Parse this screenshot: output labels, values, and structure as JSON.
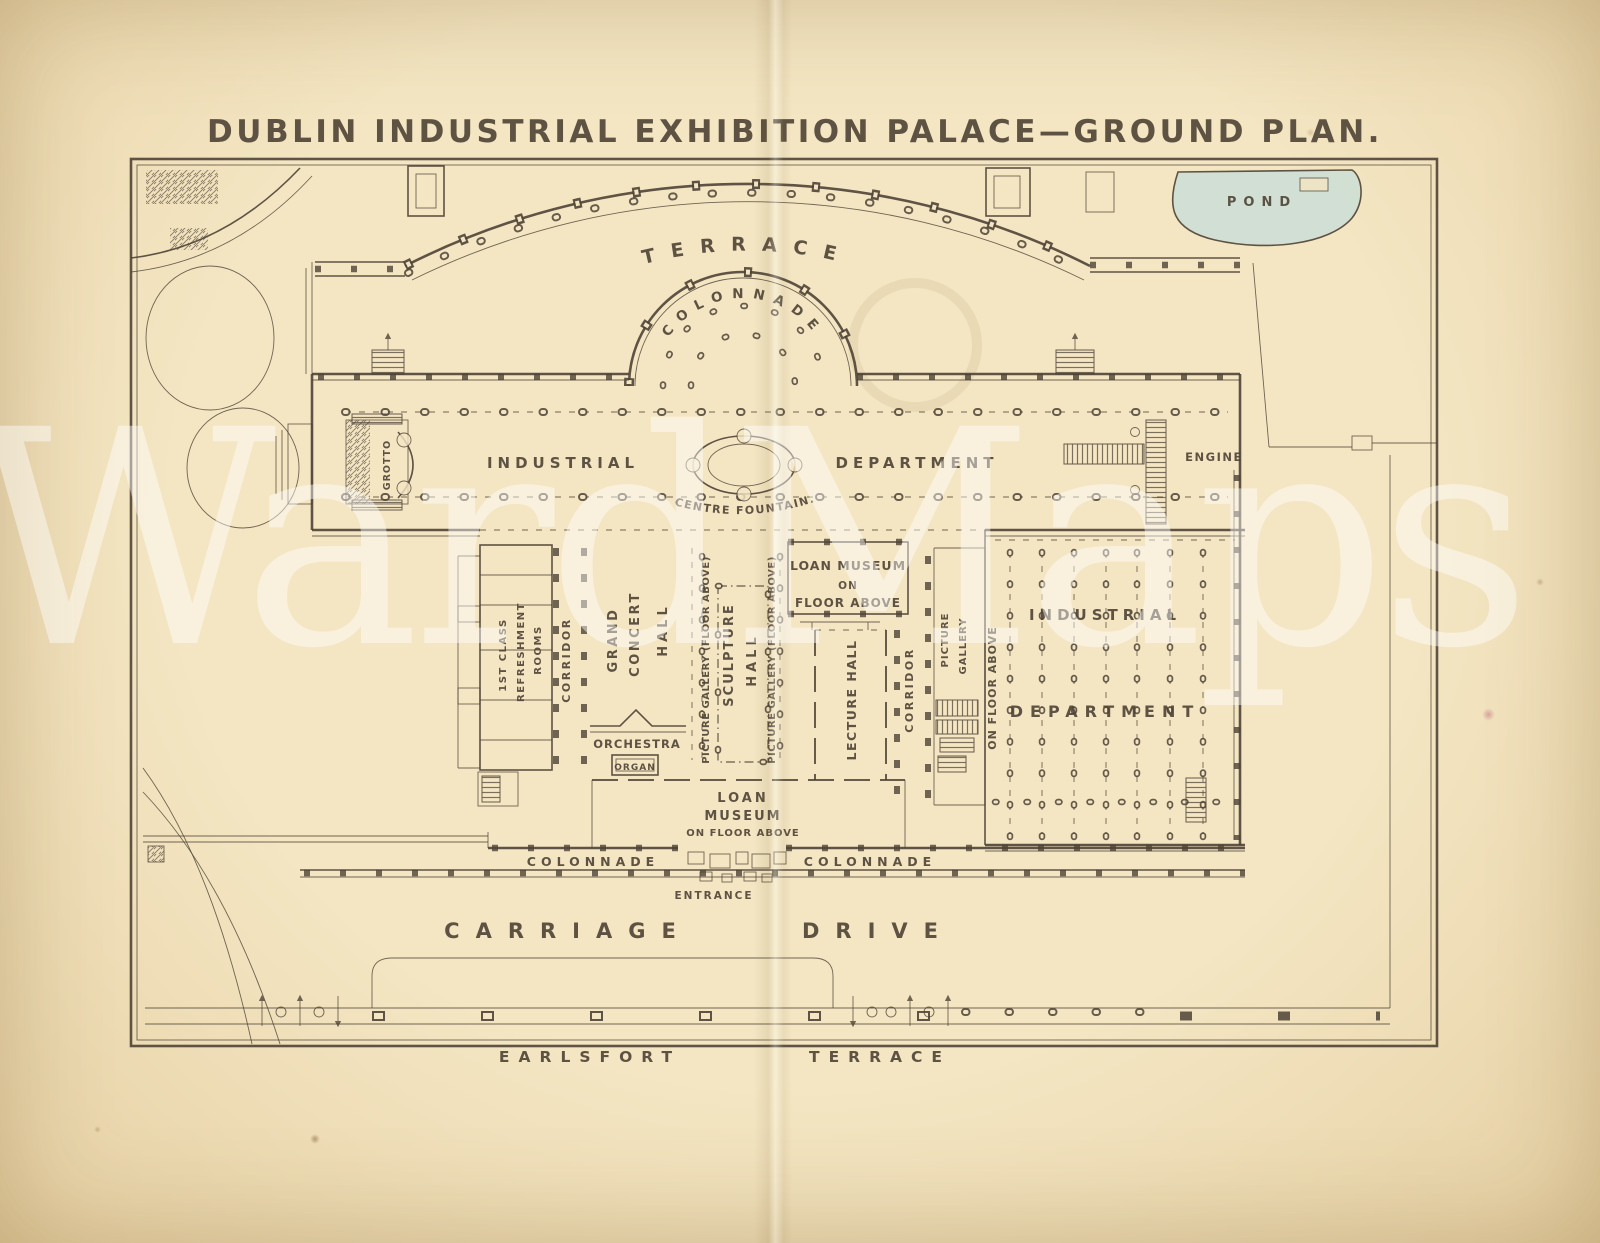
{
  "palette": {
    "paper": "#f4e6c3",
    "paper_edge": "#e6d0a4",
    "ink": "#4e4336",
    "pond": "#cfdfd6",
    "watermark": "rgba(255,255,255,0.45)"
  },
  "title": "DUBLIN INDUSTRIAL EXHIBITION PALACE—GROUND PLAN.",
  "watermark_text": "WardMaps",
  "plan": {
    "terrace": "TERRACE",
    "colonnade_arc": "COLONNADE",
    "pond": "POND",
    "industrial_hall_west": "INDUSTRIAL",
    "industrial_hall_east": "DEPARTMENT",
    "centre_fountain": "CENTRE FOUNTAIN.",
    "engine": "ENGINE",
    "grotto": "GROTTO",
    "first_class": "1ST CLASS",
    "refreshment": "REFRESHMENT",
    "rooms": "ROOMS",
    "corridor_west": "CORRIDOR",
    "grand": "GRAND",
    "concert": "CONCERT",
    "concert_hall": "HALL",
    "orchestra": "ORCHESTRA",
    "organ": "ORGAN",
    "picture_gallery_west": "PICTURE GALLERY (FLOOR ABOVE)",
    "sculpture": "SCULPTURE",
    "sculpture_hall": "HALL",
    "picture_gallery_east": "PICTURE GALLERY (FLOOR ABOVE)",
    "loan_museum_north_1": "LOAN MUSEUM",
    "loan_museum_north_2": "ON",
    "loan_museum_north_3": "FLOOR ABOVE",
    "lecture_hall": "LECTURE HALL",
    "corridor_east": "CORRIDOR",
    "picture_east_1": "PICTURE",
    "picture_east_2": "GALLERY",
    "on_floor_above_east": "ON FLOOR ABOVE",
    "industrial_dept_east_1": "INDUSTRIAL",
    "industrial_dept_east_2": "DEPARTMENT",
    "loan_museum_south_1": "LOAN",
    "loan_museum_south_2": "MUSEUM",
    "loan_museum_south_3": "ON FLOOR ABOVE",
    "colonnade_south_west": "COLONNADE",
    "colonnade_south_east": "COLONNADE",
    "entrance": "ENTRANCE",
    "carriage": "CARRIAGE",
    "drive": "DRIVE",
    "earlsfort": "EARLSFORT",
    "terrace_street": "TERRACE"
  }
}
